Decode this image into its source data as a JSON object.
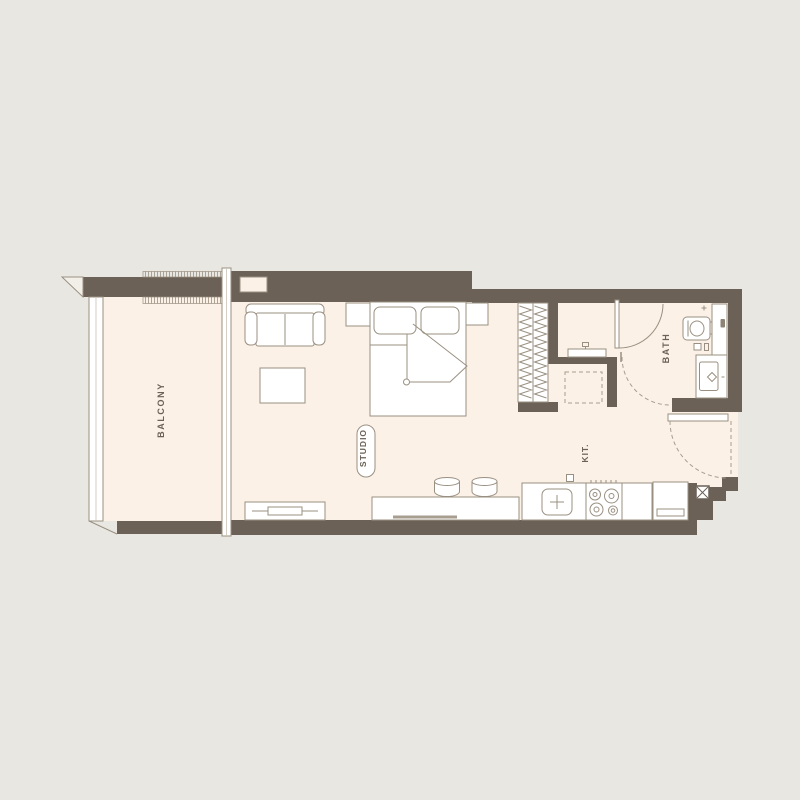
{
  "page": {
    "title": "Studio Apartment Floor Plan"
  },
  "labels": {
    "balcony": "BALCONY",
    "studio": "STUDIO",
    "kitchen": "KIT.",
    "bath": "BATH"
  },
  "colors": {
    "background": "#e9e7e2",
    "wall": "#6b6156",
    "floor": "#fcf1e6",
    "outline": "#9a9082",
    "dashed_line": "#a69d8f",
    "furniture_fill": "#ffffff",
    "label_text": "#6b6156"
  },
  "elements": [
    "exterior-walls",
    "balcony-railing",
    "balcony-louver-strips",
    "sliding-window-mullion",
    "wall-niche",
    "sofa",
    "coffee-table",
    "double-bed",
    "pillows",
    "nightstand-left",
    "nightstand-right",
    "wardrobe",
    "laundry-counter",
    "washing-machine-space",
    "bathroom-door",
    "shower-swing-dashed",
    "entry-door",
    "toilet",
    "bathroom-shelf",
    "washbasin",
    "kitchen-island",
    "bar-stools",
    "kitchen-sink",
    "stove",
    "kitchen-counter",
    "refrigerator",
    "tv-console",
    "service-shaft",
    "switch-box"
  ]
}
